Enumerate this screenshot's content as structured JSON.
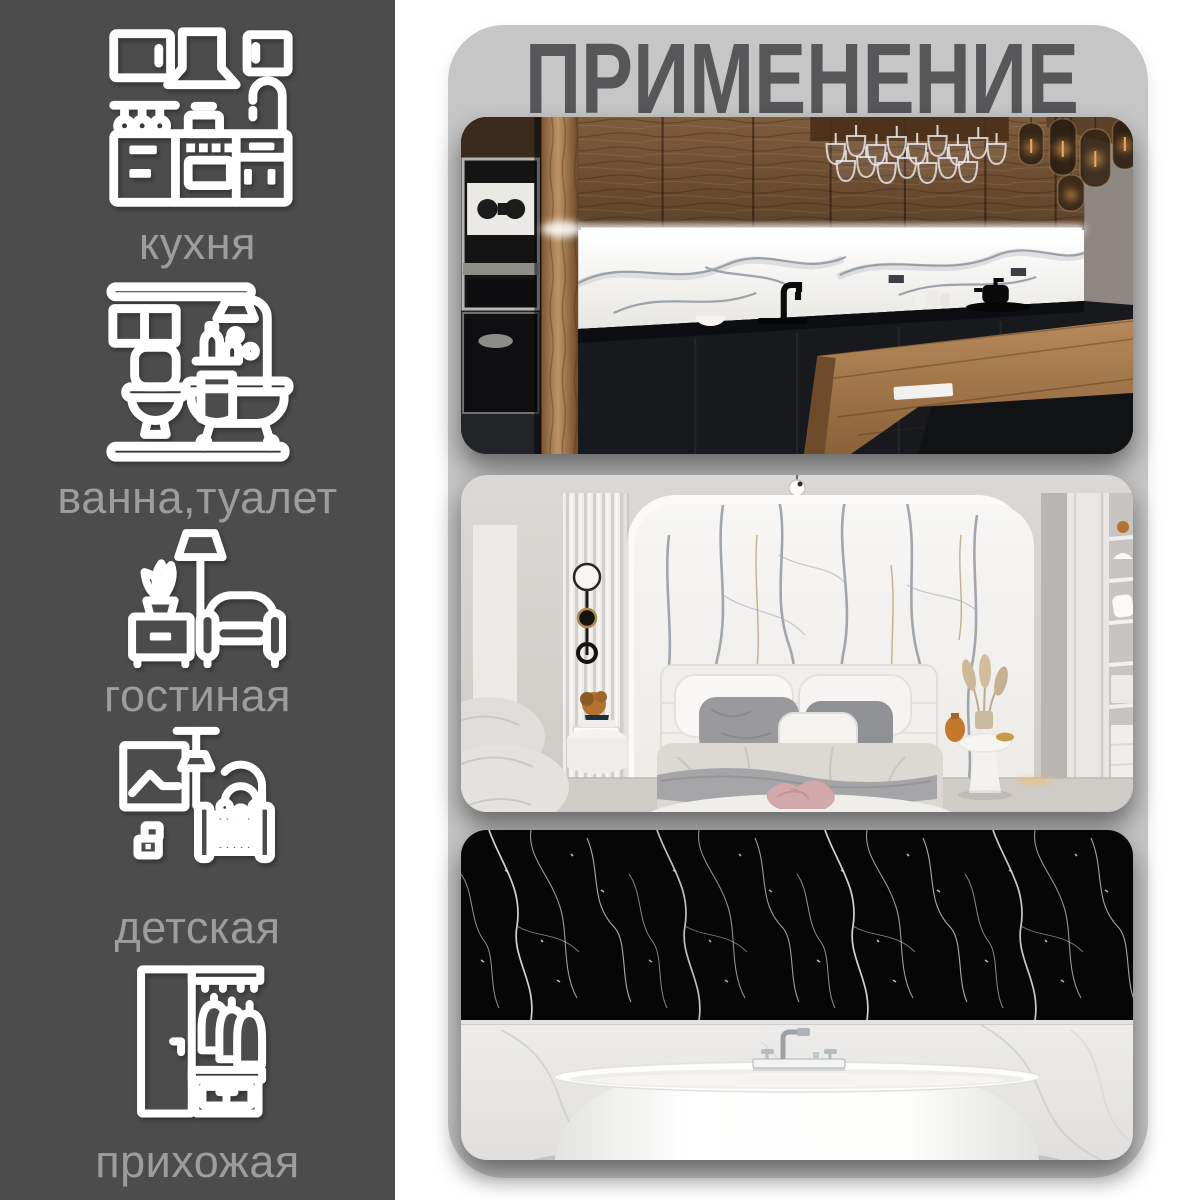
{
  "title": {
    "text": "ПРИМЕНЕНИЕ"
  },
  "sidebar": {
    "items": [
      {
        "label": "кухня",
        "icon": "kitchen-icon"
      },
      {
        "label": "ванна,туалет",
        "icon": "bathroom-icon"
      },
      {
        "label": "гостиная",
        "icon": "living-room-icon"
      },
      {
        "label": "детская",
        "icon": "nursery-icon"
      },
      {
        "label": "прихожая",
        "icon": "hallway-icon"
      }
    ]
  },
  "photos": [
    {
      "name": "kitchen-photo",
      "subject": "kitchen-with-white-marble-backsplash"
    },
    {
      "name": "bedroom-photo",
      "subject": "bedroom-with-white-marble-accent-wall"
    },
    {
      "name": "bathroom-photo",
      "subject": "bathtub-with-black-marble-wall"
    }
  ],
  "colors": {
    "sidebar_bg": "#4c4c4c",
    "panel_bg": "#c6c6c6",
    "title_text": "#57575a",
    "label_text": "#9d9d9d",
    "icon_stroke": "#ffffff",
    "page_bg": "#ffffff"
  }
}
